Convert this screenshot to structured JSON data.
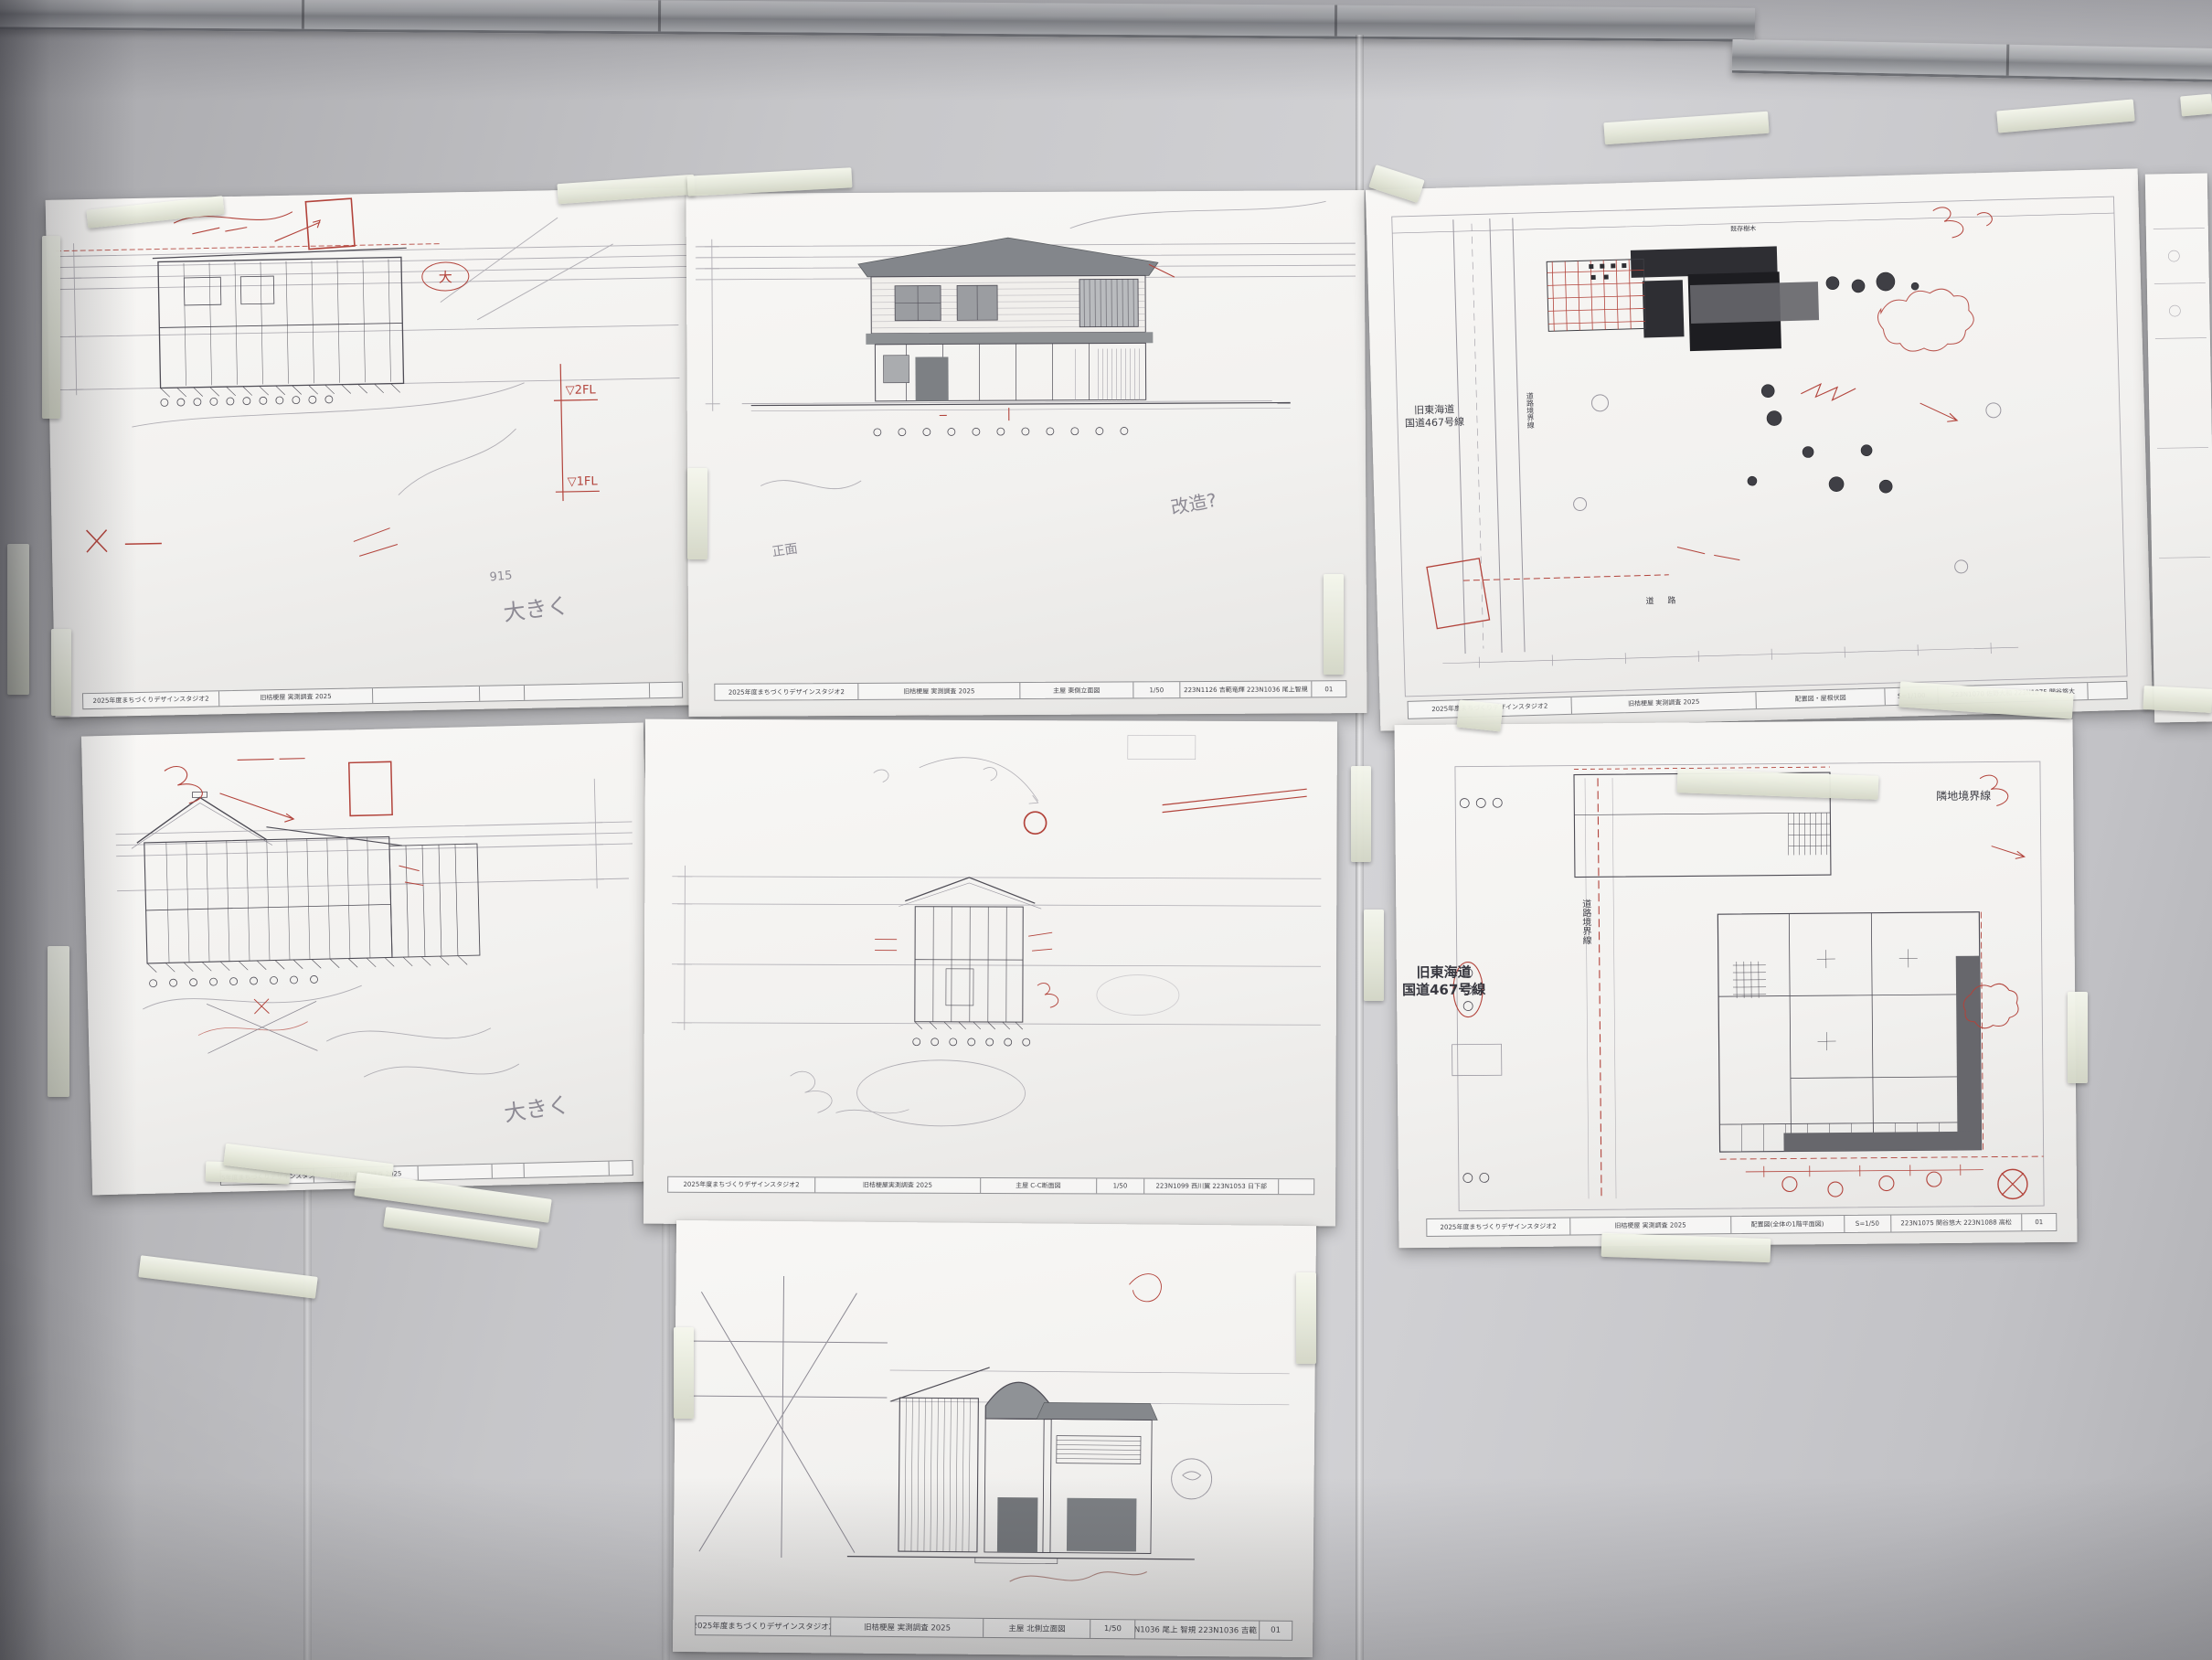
{
  "scene": {
    "type": "photograph",
    "description": "Seven hand-annotated architectural survey drawings (sections, elevations, site and floor plans) taped to a gray office partition wall with aluminum rails",
    "wall_color": "#c6c6c9",
    "paper_color": "#f4f3f1",
    "tape_color": "#e9ecdf",
    "rail_color": "#a9abae",
    "red_ink_color": "#b2433b",
    "pencil_color": "#8d8a94"
  },
  "labels": {
    "old_tokaido": "旧東海道",
    "route467": "国道467号線",
    "adjacent_boundary": "隣地境界線",
    "road_boundary": "道路境界線",
    "road": "道 路",
    "existing_trees": "既存樹木"
  },
  "notes": {
    "bigger": "大きく",
    "n915": "915",
    "fl2": "▽2FL",
    "fl1": "▽1FL",
    "front": "正面",
    "kaizo": "改造?",
    "circled_dai": "大"
  },
  "sheets": [
    {
      "id": "top-left-section",
      "position": "top-left",
      "drawing_type": "building cross section with red correction marks",
      "title_block": {
        "studio": "2025年度まちづくりデザインスタジオ2",
        "project": "旧桔梗屋 実測調査 2025",
        "subject": "",
        "scale": "",
        "authors": "",
        "sheet_no": ""
      }
    },
    {
      "id": "east-elevation",
      "position": "top-middle",
      "drawing_type": "east elevation of main house",
      "title_block": {
        "studio": "2025年度まちづくりデザインスタジオ2",
        "project": "旧桔梗屋 実測調査 2025",
        "subject": "主屋 東側立面図",
        "scale": "1/50",
        "authors": "223N1126 吉範竜輝 223N1036 尾上智規",
        "sheet_no": "01"
      }
    },
    {
      "id": "site-roof-plan",
      "position": "top-right",
      "drawing_type": "site plan / roof plan with blacked-in buildings and trees",
      "title_block": {
        "studio": "2025年度まちづくりデザインスタジオ2",
        "project": "旧桔梗屋 実測調査 2025",
        "subject": "配置図・屋根伏図",
        "scale": "S=1/100",
        "authors": "223N1070 佐野大和 223N1075 関谷悠大",
        "sheet_no": ""
      }
    },
    {
      "id": "middle-left-section",
      "position": "middle-left",
      "drawing_type": "building section with tiled gable roof, red correction marks",
      "title_block": {
        "studio": "2025年度まちづくりデザインスタジオ2",
        "project": "旧桔梗屋 実測調査 2025",
        "subject": "",
        "scale": "",
        "authors": "",
        "sheet_no": ""
      }
    },
    {
      "id": "cc-section",
      "position": "middle-center",
      "drawing_type": "C-C cross section, small figure with pencil study ovals",
      "title_block": {
        "studio": "2025年度まちづくりデザインスタジオ2",
        "project": "旧桔梗屋実測調査 2025",
        "subject": "主屋 C-C断面図",
        "scale": "1/50",
        "authors": "223N1099 西川翼 223N1053 日下部",
        "sheet_no": ""
      }
    },
    {
      "id": "site-floor-plan",
      "position": "middle-right",
      "drawing_type": "site plan with ground floor plan, boundary lines and red survey marks",
      "title_block": {
        "studio": "2025年度まちづくりデザインスタジオ2",
        "project": "旧桔梗屋 実測調査 2025",
        "subject": "配置図(全体の1階平面図)",
        "scale": "S=1/50",
        "authors": "223N1075 関谷悠大 223N1088 高松",
        "sheet_no": "01"
      }
    },
    {
      "id": "north-elevation",
      "position": "bottom-center",
      "drawing_type": "north elevation of main house, large pencil cross-out at left",
      "title_block": {
        "studio": "2025年度まちづくりデザインスタジオ2",
        "project": "旧桔梗屋 実測調査 2025",
        "subject": "主屋 北側立面図",
        "scale": "1/50",
        "authors": "223N1036 尾上 智規 223N1036 吉範 竜輝",
        "sheet_no": "01"
      }
    }
  ]
}
